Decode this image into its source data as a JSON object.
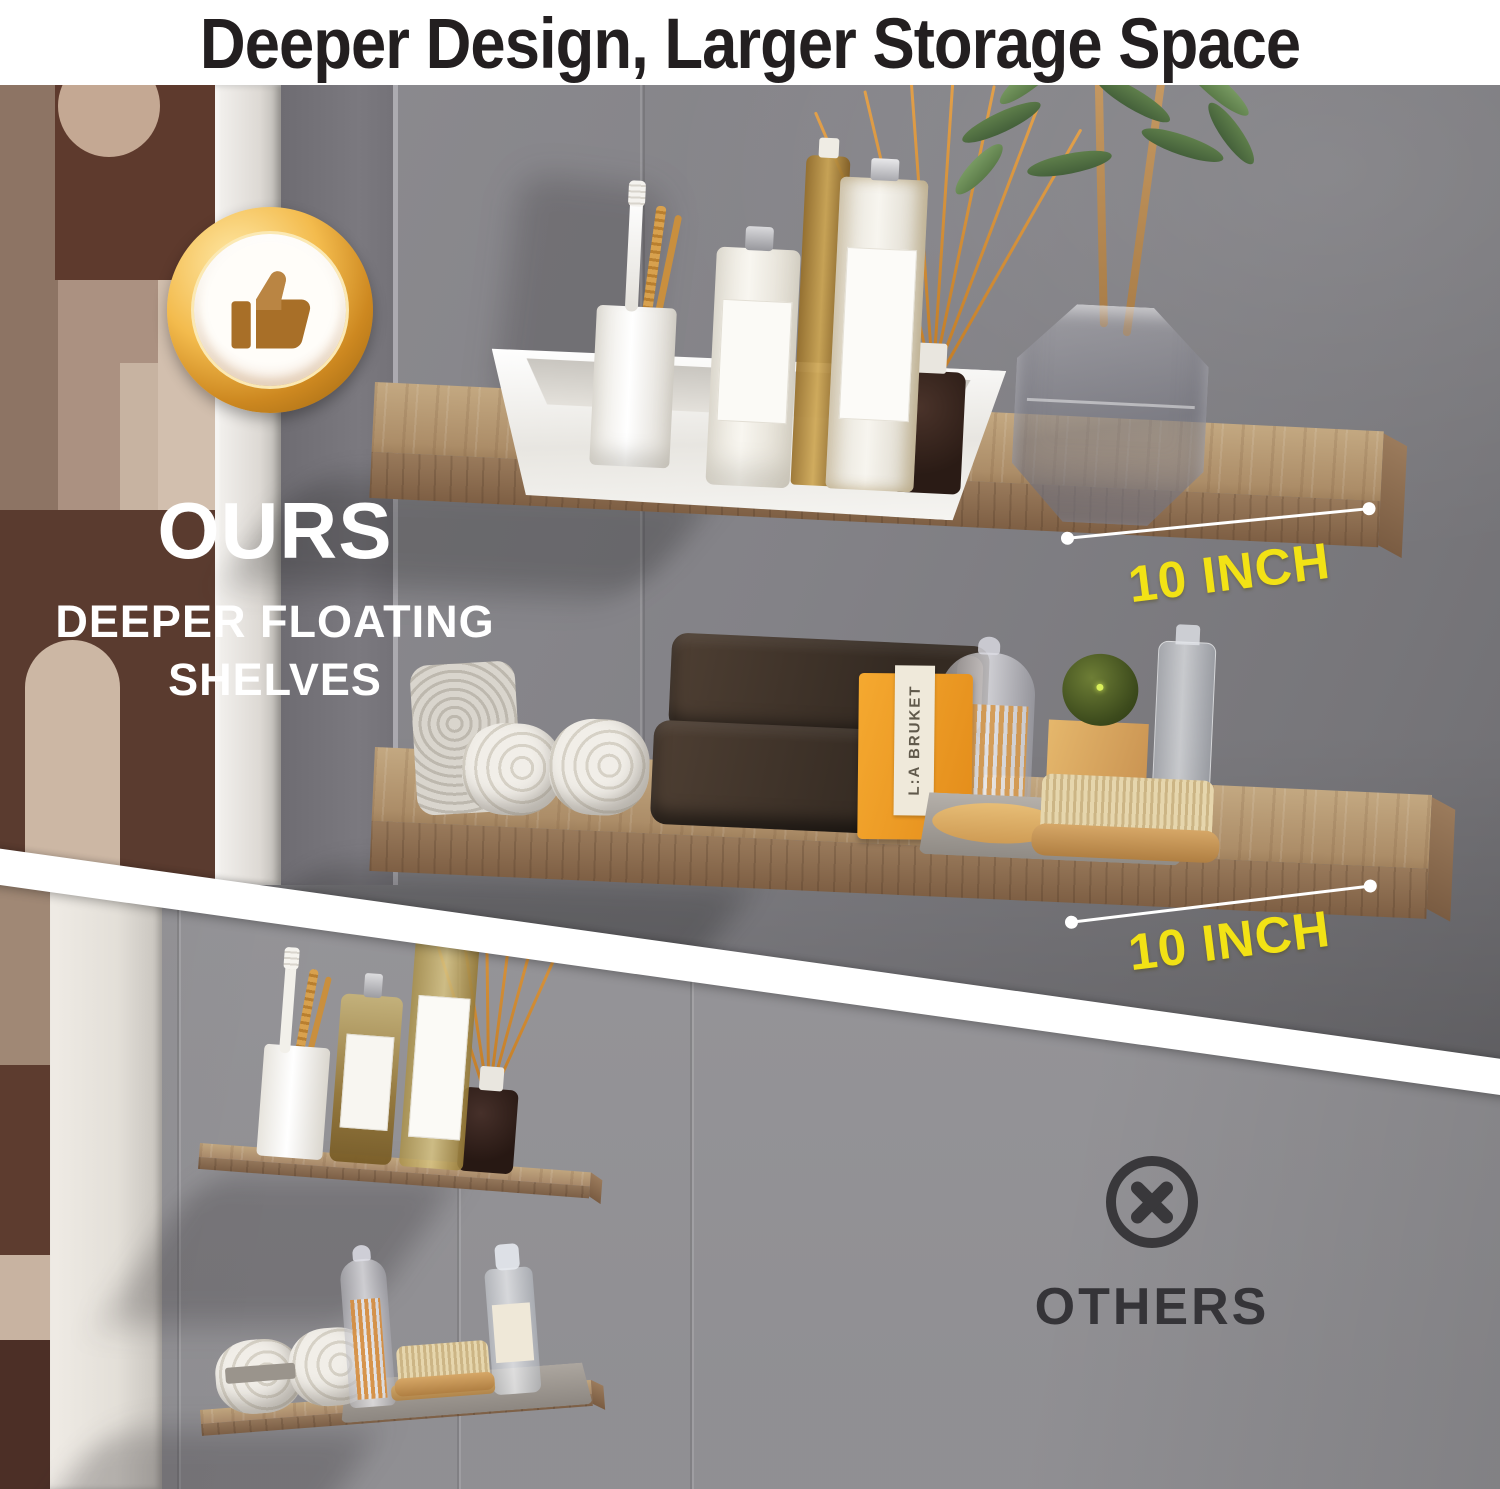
{
  "header": {
    "title": "Deeper Design, Larger Storage Space"
  },
  "ours": {
    "badge_icon": "thumbs-up-icon",
    "title": "OURS",
    "subtitle_lines": [
      "DEEPER FLOATING",
      "SHELVES"
    ],
    "shelf_depth_label_top": "10 INCH",
    "shelf_depth_label_bottom": "10 INCH",
    "decor": {
      "soap_box_brand": "L:A BRUKET"
    }
  },
  "others": {
    "icon": "x-circle-icon",
    "title": "OTHERS"
  },
  "colors": {
    "accent_yellow": "#F2E215",
    "badge_gold": "#E8A93D",
    "thumb_brown": "#A86F28",
    "wood_shelf": "#AC8D68",
    "wall_top_gray": "#838287",
    "wall_bottom_gray": "#98979B",
    "title_black": "#231F20",
    "others_dark": "#39383B",
    "white": "#FFFFFF"
  }
}
